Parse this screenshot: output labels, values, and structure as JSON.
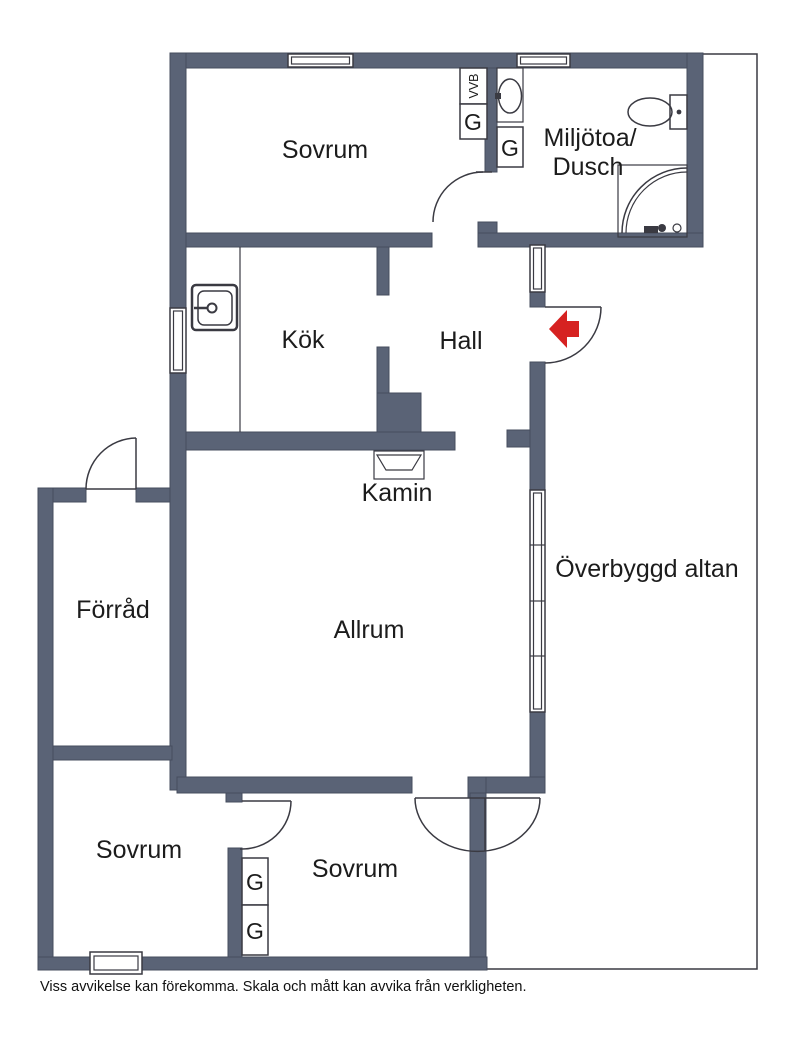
{
  "floorplan": {
    "rooms": {
      "sovrum_top": "Sovrum",
      "miljotoa_line1": "Miljötoa/",
      "miljotoa_line2": "Dusch",
      "kok": "Kök",
      "hall": "Hall",
      "kamin": "Kamin",
      "overbyggd_altan": "Överbyggd altan",
      "forrad": "Förråd",
      "allrum": "Allrum",
      "sovrum_bottom_left": "Sovrum",
      "sovrum_bottom_middle": "Sovrum"
    },
    "closets": {
      "vvb": "VVB",
      "g": "G"
    },
    "colors": {
      "wall": "#5A6376",
      "wall_edge": "#454C5E",
      "line": "#3A3A42",
      "entry_arrow": "#D62221",
      "background": "#FFFFFF"
    }
  },
  "footer": {
    "disclaimer": "Viss avvikelse kan förekomma. Skala och mått kan avvika från verkligheten."
  }
}
